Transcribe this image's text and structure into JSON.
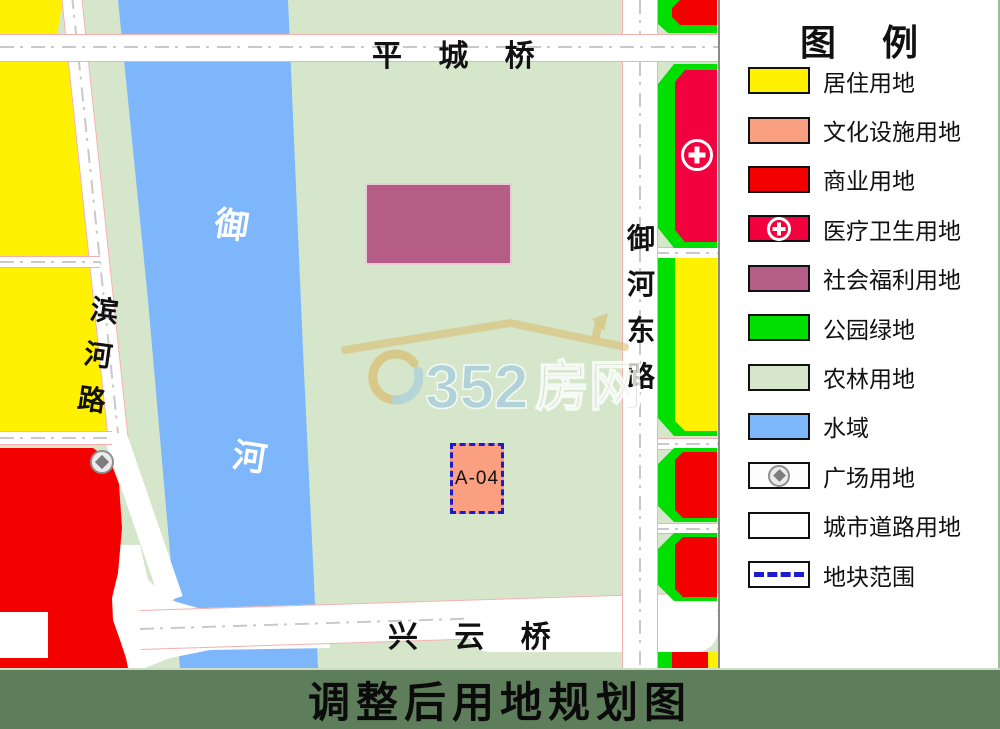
{
  "colors": {
    "agri": "#D5E6CB",
    "water": "#7DB6FA",
    "residential": "#FFF100",
    "commercial": "#F30000",
    "medical": "#F1013E",
    "welfare": "#B55C87",
    "park": "#00DF00",
    "cultural": "#FA9F7F",
    "road-white": "#FFFFFF",
    "road-edge": "#F4AFAF",
    "plot-dash": "#1C1CCE",
    "titlebar": "#5E7E5B",
    "divider": "#8A8A8A",
    "wm-gold": "#D9BE72",
    "wm-blue": "#A9CEDC",
    "wm-gray": "#CFD3C9"
  },
  "map": {
    "bridge_top": "平 城 桥",
    "bridge_bottom": "兴 云 桥",
    "river_chars": [
      "御",
      "河"
    ],
    "left_road_chars": [
      "滨",
      "河",
      "路"
    ],
    "right_road_chars": [
      "御",
      "河",
      "东",
      "路"
    ],
    "plot_label": "A-04",
    "watermark": {
      "number": "0352",
      "suffix": "房网"
    }
  },
  "legend": {
    "title": "图  例",
    "items": [
      {
        "label": "居住用地",
        "color": "#FFF100",
        "type": "fill"
      },
      {
        "label": "文化设施用地",
        "color": "#FA9F7F",
        "type": "fill"
      },
      {
        "label": "商业用地",
        "color": "#F30000",
        "type": "fill"
      },
      {
        "label": "医疗卫生用地",
        "color": "#F1013E",
        "type": "medical"
      },
      {
        "label": "社会福利用地",
        "color": "#B55C87",
        "type": "fill"
      },
      {
        "label": "公园绿地",
        "color": "#00DF00",
        "type": "fill"
      },
      {
        "label": "农林用地",
        "color": "#D5E6CB",
        "type": "fill"
      },
      {
        "label": "水域",
        "color": "#7DB6FA",
        "type": "fill"
      },
      {
        "label": "广场用地",
        "color": "#FDFDFD",
        "type": "plaza"
      },
      {
        "label": "城市道路用地",
        "color": "#FFFFFF",
        "type": "fill"
      },
      {
        "label": "地块范围",
        "color": "#FFFFFF",
        "type": "boundary"
      }
    ]
  },
  "title_bar": {
    "text": "调整后用地规划图"
  }
}
